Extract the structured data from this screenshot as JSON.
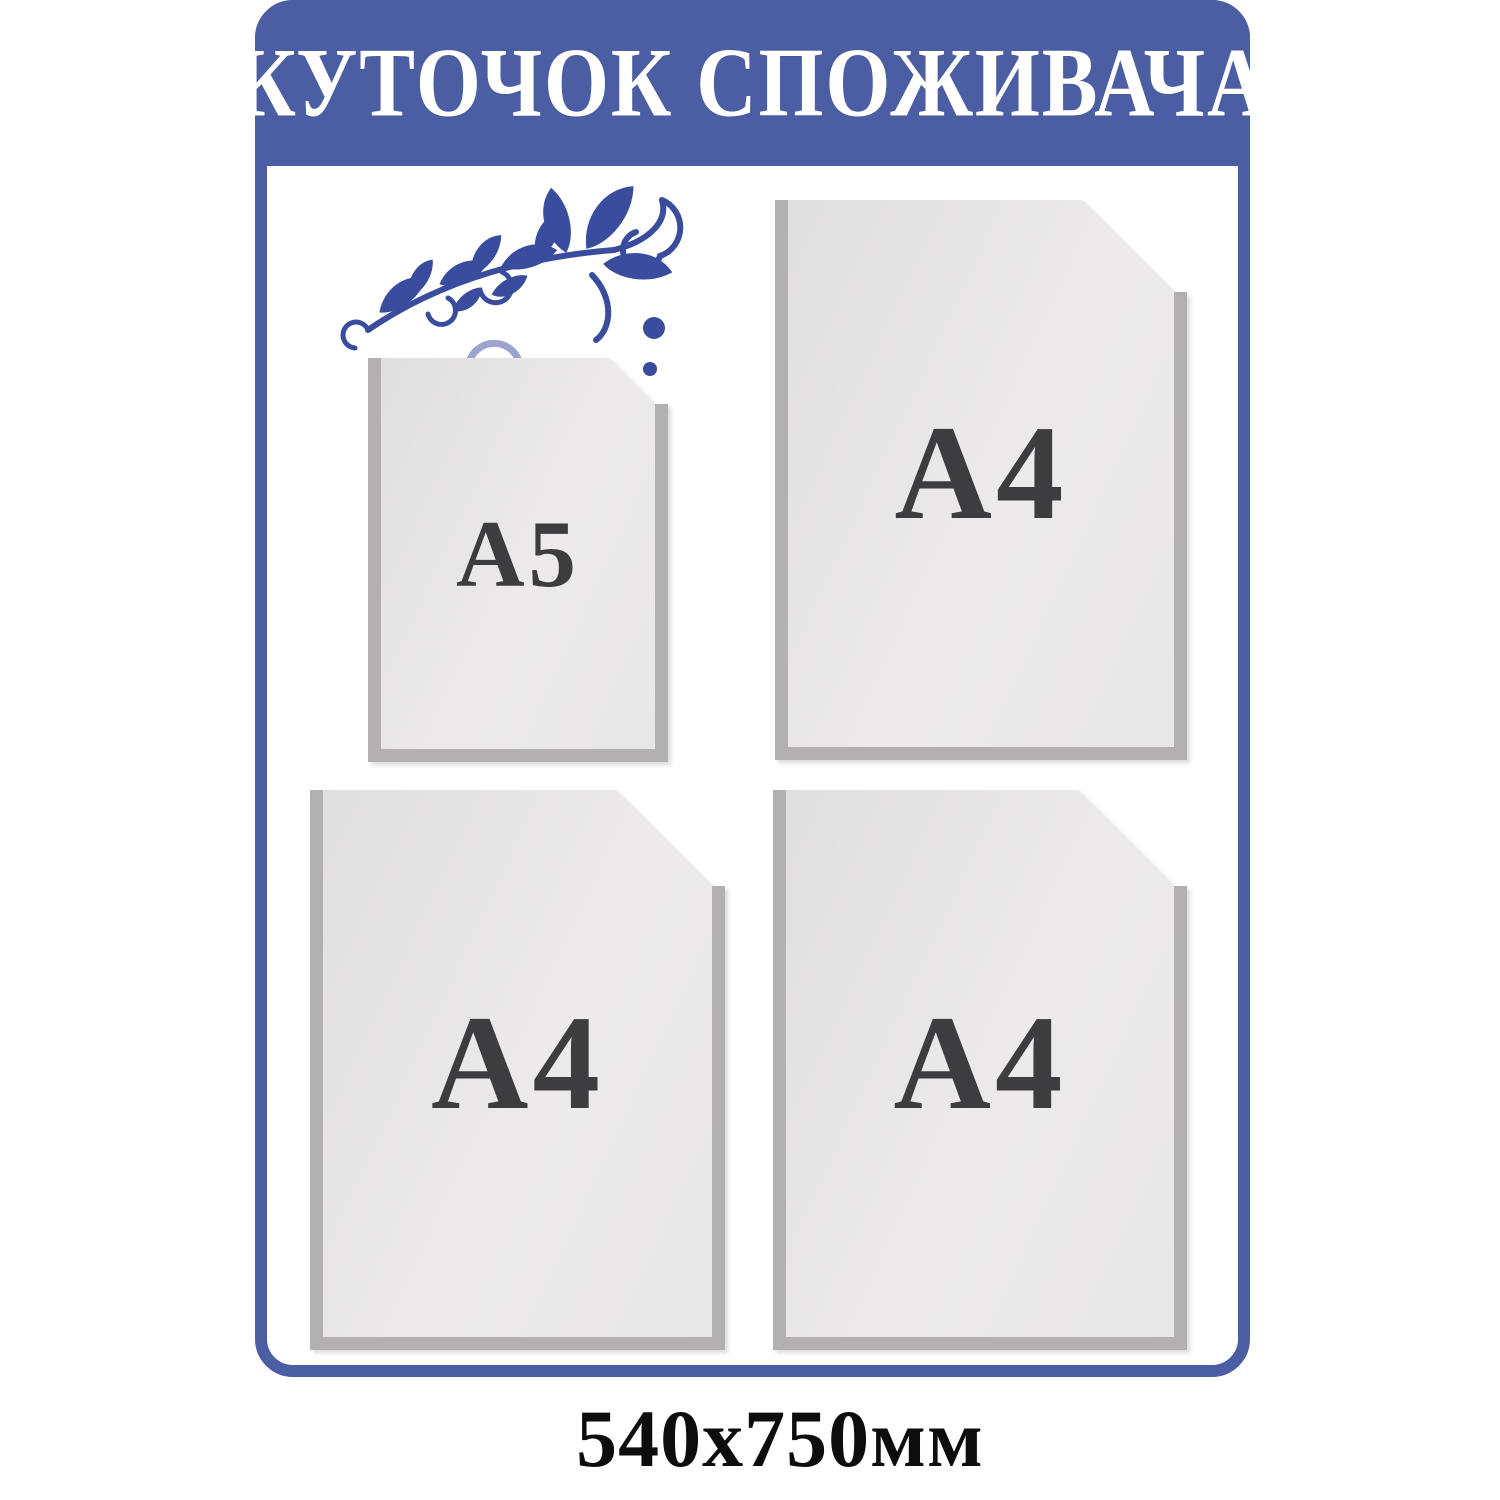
{
  "board": {
    "header": {
      "title": "КУТОЧОК СПОЖИВАЧА"
    },
    "pockets": [
      {
        "name": "a5-pocket",
        "label": "A5"
      },
      {
        "name": "a4-pocket-top-right",
        "label": "A4"
      },
      {
        "name": "a4-pocket-bottom-left",
        "label": "A4"
      },
      {
        "name": "a4-pocket-bottom-right",
        "label": "A4"
      }
    ],
    "ornament_icon": "floral-flourish"
  },
  "caption": {
    "text": "540x750мм"
  },
  "theme": {
    "frame_blue": "#4c5ea3",
    "ornament_blue": "#3a4c9e",
    "pocket_fill": "#e8e7e7",
    "pocket_border": "#b2b0b0",
    "label_color": "#3d3c3e",
    "caption_color": "#0d0d0d",
    "title_color": "#ffffff"
  }
}
